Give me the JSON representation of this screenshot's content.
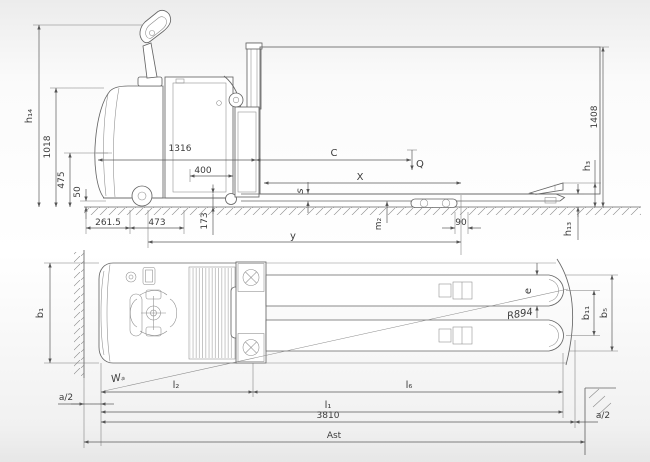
{
  "figure": {
    "description": "Two-view dimensional engineering drawing of an electric stand-on pallet truck with load",
    "labels": {
      "h14": "h₁₄",
      "d1018": "1018",
      "d475": "475",
      "d50": "50",
      "d261_5": "261.5",
      "d473": "473",
      "d173": "173",
      "d1316": "1316",
      "d400": "400",
      "C": "C",
      "Q": "Q",
      "X": "X",
      "s": "s",
      "y": "y",
      "m2": "m₂",
      "d90": "90",
      "d1408": "1408",
      "h3": "h₃",
      "h13": "h₁₃",
      "b1": "b₁",
      "a2": "a/2",
      "Wa": "Wₐ",
      "l2": "l₂",
      "l6": "l₆",
      "l1": "l₁",
      "d3810": "3810",
      "Ast": "Ast",
      "e": "e",
      "R894": "R894",
      "b11": "b₁₁",
      "b5": "b₅"
    },
    "line_color": "#666666",
    "dim_color": "#5a5a5a",
    "text_color": "#3c3c3c"
  }
}
